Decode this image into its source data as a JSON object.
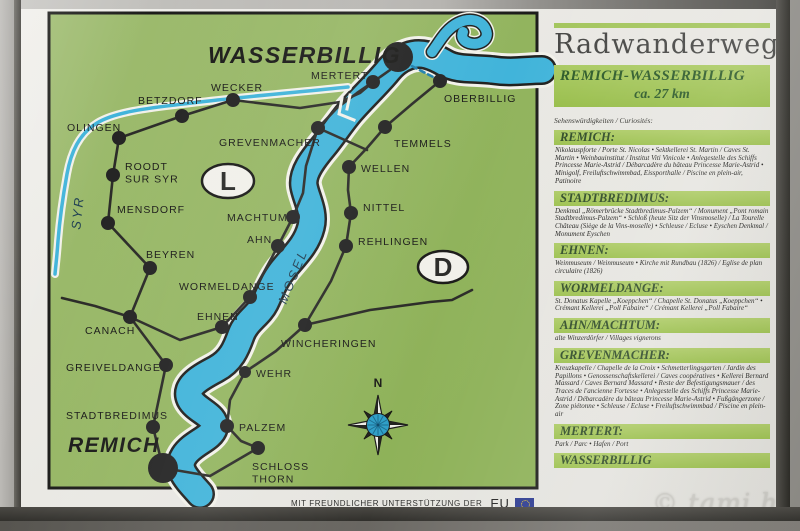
{
  "photo": {
    "watermark": "© tami.hu"
  },
  "footer": {
    "credit": "MIT FREUNDLICHER UNTERSTÜTZUNG DER",
    "eu": "EU"
  },
  "panel": {
    "title": "Radwanderweg",
    "route_box": {
      "line1": "REMICH-WASSERBILLIG",
      "line2": "ca. 27 km"
    },
    "subtitle": "Sehenswürdigkeiten / Curiosités:",
    "sections": [
      {
        "title": "REMICH:",
        "body": "Nikolauspforte / Porte St. Nicolas • Sektkellerei St. Martin / Caves St. Martin • Weinbauinstitut / Institut Viti Vinicole • Anlegestelle des Schiffs Princesse Marie-Astrid / Débarcadère du bâteau Princesse Marie-Astrid • Minigolf, Freiluftschwimmbad, Eissporthalle / Piscine en plein-air, Patinoire"
      },
      {
        "title": "STADTBREDIMUS:",
        "body": "Denkmal „Römerbrücke Stadtbredimus-Palzem“ / Monument „Pont romain Stadtbredimus-Palzem“ • Schloß (heute Sitz der Vinsmoselle) / La Tourelle Château (Siège de la Vins-moselle) • Schleuse / Ecluse • Eyschen Denkmal / Monument Eyschen"
      },
      {
        "title": "EHNEN:",
        "body": "Weinmuseum / Weinmuseum • Kirche mit Rundbau (1826) / Eglise de plan circulaire (1826)"
      },
      {
        "title": "WORMELDANGE:",
        "body": "St. Donatus Kapelle „Koeppchen“ / Chapelle St. Donatus „Koeppchen“ • Crémant Kellerei „Poll Fabaire“ / Crémant Kellerei „Poll Fabaire“"
      },
      {
        "title": "AHN/MACHTUM:",
        "body": "alte Winzerdörfer / Villages vignerons"
      },
      {
        "title": "GREVENMACHER:",
        "body": "Kreuzkapelle / Chapelle de la Croix • Schmetterlingsgarten / Jardin des Papillons • Genossenschaftskellerei / Caves coopératives • Kellerei Bernard Massard / Caves Bernard Massard • Reste der Befestigungsmauer / des Traces de l'ancienne Fortesse • Anlegestelle des Schiffs Princesse Marie-Astrid / Débarcadère du bâteau Princesse Marie-Astrid • Fußgängerzone / Zone piétonne • Schleuse / Ecluse • Freiluftschwimmbad / Piscine en plein-air"
      },
      {
        "title": "MERTERT:",
        "body": "Park / Parc • Hafen / Port"
      },
      {
        "title": "WASSERBILLIG",
        "body": ""
      }
    ]
  },
  "map": {
    "colors": {
      "land1": "#9dba6e",
      "land2": "#8fb258",
      "water": "#41b4da",
      "casing": "#f2f1ea",
      "outline": "#20201e",
      "route": "#2b2b28",
      "dot": "#242424",
      "border": "#1c1c1a",
      "ferry": "#1f7fae"
    },
    "rivers": [
      {
        "name": "mosel-river",
        "d": "M 200,494 C 186,478 176,469 184,456 C 192,443 211,439 214,428 C 217,415 196,411 190,399 C 184,386 201,377 216,369 C 231,361 236,349 241,335 C 246,321 259,315 265,303 C 271,291 273,281 285,267 C 297,253 307,243 311,227 C 315,212 306,198 304,186 C 302,173 313,159 323,147 C 333,135 339,125 349,113 C 361,99 374,87 386,73 C 394,63 400,59 408,56 C 421,51 433,56 445,63 C 457,70 472,68 492,70 C 512,73 526,70 542,70",
        "layers": [
          [
            "casing",
            36
          ],
          [
            "outline",
            30
          ],
          [
            "water",
            25
          ]
        ]
      },
      {
        "name": "sauer-river",
        "d": "M 432,52 C 440,41 446,29 458,23 C 470,17 482,20 486,30 C 490,40 479,46 469,43 C 463,41 461,37 463,32",
        "layers": [
          [
            "casing",
            16
          ],
          [
            "outline",
            13
          ],
          [
            "water",
            10
          ]
        ]
      },
      {
        "name": "syr-river",
        "d": "M 348,87 C 300,92 250,96 200,102 C 160,107 118,110 97,123 C 79,134 71,152 67,174 C 63,196 60,216 58,241 C 57,256 56,263 55,274",
        "layers": [
          [
            "casing",
            8
          ],
          [
            "water",
            3.5
          ]
        ]
      }
    ],
    "routes": [
      {
        "name": "route-luxembourg-loop",
        "pts": [
          [
            163,
            468
          ],
          [
            153,
            427
          ],
          [
            166,
            365
          ],
          [
            130,
            317
          ],
          [
            150,
            268
          ],
          [
            108,
            223
          ],
          [
            113,
            175
          ],
          [
            119,
            138
          ],
          [
            182,
            116
          ],
          [
            233,
            100
          ],
          [
            300,
            108
          ],
          [
            340,
            102
          ],
          [
            360,
            93
          ],
          [
            373,
            82
          ],
          [
            390,
            70
          ],
          [
            398,
            57
          ]
        ]
      },
      {
        "name": "route-mosel-west-bank",
        "pts": [
          [
            222,
            327
          ],
          [
            250,
            297
          ],
          [
            264,
            272
          ],
          [
            278,
            246
          ],
          [
            293,
            217
          ],
          [
            303,
            193
          ],
          [
            306,
            166
          ],
          [
            318,
            128
          ],
          [
            337,
            108
          ],
          [
            357,
            93
          ],
          [
            373,
            82
          ]
        ]
      },
      {
        "name": "route-canach-west-stub",
        "pts": [
          [
            130,
            317
          ],
          [
            95,
            306
          ],
          [
            62,
            298
          ]
        ]
      },
      {
        "name": "route-canach-ehnen",
        "pts": [
          [
            130,
            317
          ],
          [
            180,
            340
          ],
          [
            222,
            327
          ]
        ]
      },
      {
        "name": "route-german-bank",
        "pts": [
          [
            440,
            81
          ],
          [
            412,
            104
          ],
          [
            385,
            127
          ],
          [
            367,
            148
          ],
          [
            349,
            167
          ],
          [
            348,
            190
          ],
          [
            351,
            213
          ],
          [
            346,
            246
          ],
          [
            331,
            281
          ],
          [
            305,
            325
          ],
          [
            276,
            351
          ],
          [
            245,
            372
          ],
          [
            230,
            400
          ],
          [
            227,
            426
          ],
          [
            241,
            441
          ],
          [
            258,
            448
          ],
          [
            210,
            476
          ],
          [
            163,
            468
          ]
        ]
      },
      {
        "name": "route-grevenmacher-bridge",
        "pts": [
          [
            318,
            128
          ],
          [
            367,
            150
          ]
        ]
      },
      {
        "name": "route-wincheringen-east-stub",
        "pts": [
          [
            305,
            325
          ],
          [
            370,
            310
          ],
          [
            430,
            302
          ],
          [
            452,
            300
          ],
          [
            472,
            290
          ]
        ]
      },
      {
        "name": "ferry-line",
        "dashed": true,
        "pts": [
          [
            404,
            62
          ],
          [
            437,
            79
          ]
        ]
      }
    ],
    "marks": [
      {
        "name": "harbor-lock-mark",
        "d": "M342,98 L339,114 L354,120"
      },
      {
        "name": "harbor-lock-mark",
        "d": "M350,95 L347,109"
      }
    ],
    "towns": [
      {
        "label": [
          "WASSERBILLIG"
        ],
        "x": 398,
        "y": 57,
        "r": 15,
        "lx": 208,
        "ly": 63,
        "big": 23
      },
      {
        "label": [
          "MERTERT"
        ],
        "x": 373,
        "y": 82,
        "r": 7,
        "lx": 311,
        "ly": 79
      },
      {
        "label": [
          "WECKER"
        ],
        "x": 233,
        "y": 100,
        "r": 7,
        "lx": 211,
        "ly": 91
      },
      {
        "label": [
          "BETZDORF"
        ],
        "x": 182,
        "y": 116,
        "r": 7,
        "lx": 138,
        "ly": 104
      },
      {
        "label": [
          "OLINGEN"
        ],
        "x": 119,
        "y": 138,
        "r": 7,
        "lx": 67,
        "ly": 131
      },
      {
        "label": [
          "ROODT",
          "SUR SYR"
        ],
        "x": 113,
        "y": 175,
        "r": 7,
        "lx": 125,
        "ly": 170
      },
      {
        "label": [
          "MENSDORF"
        ],
        "x": 108,
        "y": 223,
        "r": 7,
        "lx": 117,
        "ly": 213
      },
      {
        "label": [
          "BEYREN"
        ],
        "x": 150,
        "y": 268,
        "r": 7,
        "lx": 146,
        "ly": 258
      },
      {
        "label": [
          "CANACH"
        ],
        "x": 130,
        "y": 317,
        "r": 7,
        "lx": 85,
        "ly": 334
      },
      {
        "label": [
          "GREIVELDANGE"
        ],
        "x": 166,
        "y": 365,
        "r": 7,
        "lx": 66,
        "ly": 371
      },
      {
        "label": [
          "STADTBREDIMUS"
        ],
        "x": 153,
        "y": 427,
        "r": 7,
        "lx": 66,
        "ly": 419
      },
      {
        "label": [
          "REMICH"
        ],
        "x": 163,
        "y": 468,
        "r": 15,
        "lx": 68,
        "ly": 452,
        "big": 21
      },
      {
        "label": [
          "EHNEN"
        ],
        "x": 222,
        "y": 327,
        "r": 7,
        "lx": 197,
        "ly": 320
      },
      {
        "label": [
          "WORMELDANGE"
        ],
        "x": 250,
        "y": 297,
        "r": 7,
        "lx": 179,
        "ly": 290
      },
      {
        "label": [
          "AHN"
        ],
        "x": 278,
        "y": 246,
        "r": 7,
        "lx": 247,
        "ly": 243
      },
      {
        "label": [
          "MACHTUM"
        ],
        "x": 293,
        "y": 217,
        "r": 7,
        "lx": 227,
        "ly": 221
      },
      {
        "label": [
          "GREVENMACHER"
        ],
        "x": 318,
        "y": 128,
        "r": 7,
        "lx": 219,
        "ly": 146
      },
      {
        "label": [
          "OBERBILLIG"
        ],
        "x": 440,
        "y": 81,
        "r": 7,
        "lx": 444,
        "ly": 102
      },
      {
        "label": [
          "TEMMELS"
        ],
        "x": 385,
        "y": 127,
        "r": 7,
        "lx": 394,
        "ly": 147
      },
      {
        "label": [
          "WELLEN"
        ],
        "x": 349,
        "y": 167,
        "r": 7,
        "lx": 361,
        "ly": 172
      },
      {
        "label": [
          "NITTEL"
        ],
        "x": 351,
        "y": 213,
        "r": 7,
        "lx": 363,
        "ly": 211
      },
      {
        "label": [
          "REHLINGEN"
        ],
        "x": 346,
        "y": 246,
        "r": 7,
        "lx": 358,
        "ly": 245
      },
      {
        "label": [
          "WINCHERINGEN"
        ],
        "x": 305,
        "y": 325,
        "r": 7,
        "lx": 281,
        "ly": 347
      },
      {
        "label": [
          "WEHR"
        ],
        "x": 245,
        "y": 372,
        "r": 6,
        "lx": 256,
        "ly": 377
      },
      {
        "label": [
          "PALZEM"
        ],
        "x": 227,
        "y": 426,
        "r": 7,
        "lx": 239,
        "ly": 431
      },
      {
        "label": [
          "SCHLOSS",
          "THORN"
        ],
        "x": 258,
        "y": 448,
        "r": 7,
        "lx": 252,
        "ly": 470
      }
    ],
    "region_letters": [
      {
        "letter": "L",
        "x": 228,
        "y": 181,
        "rx": 26,
        "ry": 17
      },
      {
        "letter": "D",
        "x": 443,
        "y": 267,
        "rx": 25,
        "ry": 16
      }
    ],
    "river_labels": [
      {
        "text": "MOSEL",
        "x": 297,
        "y": 278,
        "rotate": -68
      },
      {
        "text": "SYR",
        "x": 82,
        "y": 213,
        "rotate": -84
      }
    ],
    "compass": {
      "x": 378,
      "y": 425,
      "label": "N"
    }
  }
}
